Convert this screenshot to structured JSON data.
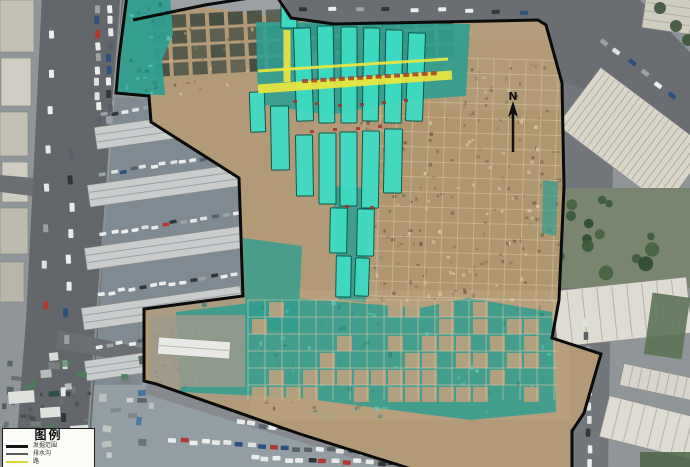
{
  "map": {
    "kind": "annotated aerial orthophoto of archaeological excavation site",
    "north_label": "N",
    "colors": {
      "boundary": "#0b0b0b",
      "trench_highlight": "#3edcc3",
      "trench_outline": "#0d5247",
      "tarp": "#2f9e90",
      "road_alignment": "#ede73e",
      "alignment_text": "#a03428",
      "dirt": "#b29a77"
    }
  },
  "legend": {
    "title": "图例",
    "items": [
      {
        "label": "发掘范围",
        "color": "#141414",
        "thickness": 3
      },
      {
        "label": "排水沟",
        "color": "#5a5a5a",
        "thickness": 2
      },
      {
        "label": "路",
        "color": "#ddd43a",
        "thickness": 2
      }
    ]
  }
}
